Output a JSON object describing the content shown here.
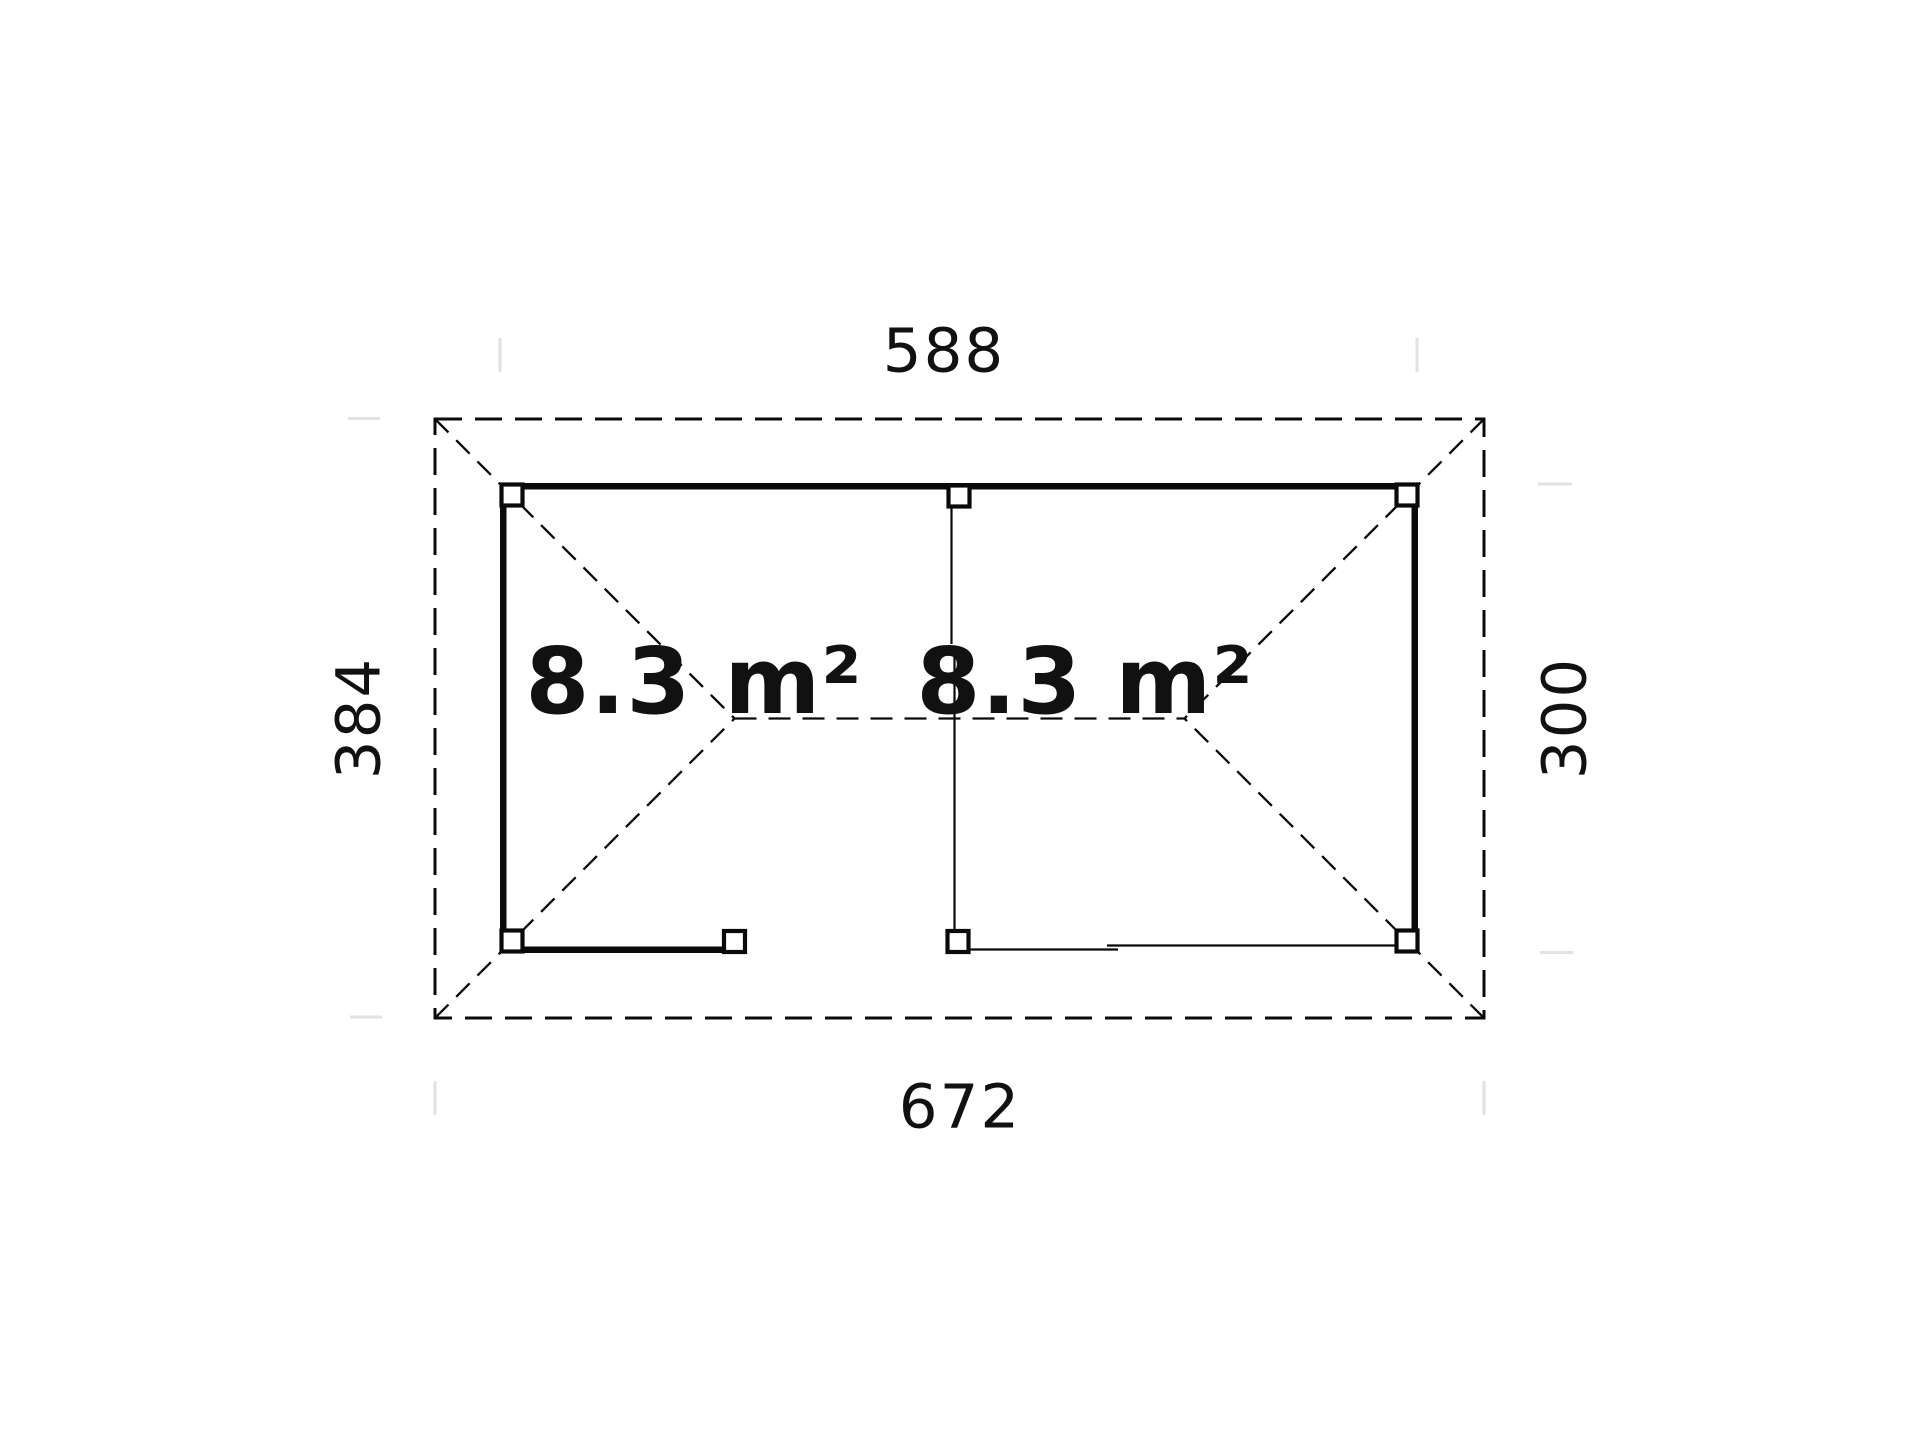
{
  "plan": {
    "title": "gazebo-floor-plan",
    "dimensions": {
      "top_width": "588",
      "bottom_width": "672",
      "left_height": "384",
      "right_height": "300"
    },
    "rooms": [
      {
        "id": "left-room",
        "area": "8.3 m²"
      },
      {
        "id": "right-room",
        "area": "8.3 m²"
      }
    ],
    "colors": {
      "line": "#0a0a0a",
      "text": "#111111",
      "extension_tick": "#e2e2e2",
      "background": "#ffffff"
    }
  }
}
